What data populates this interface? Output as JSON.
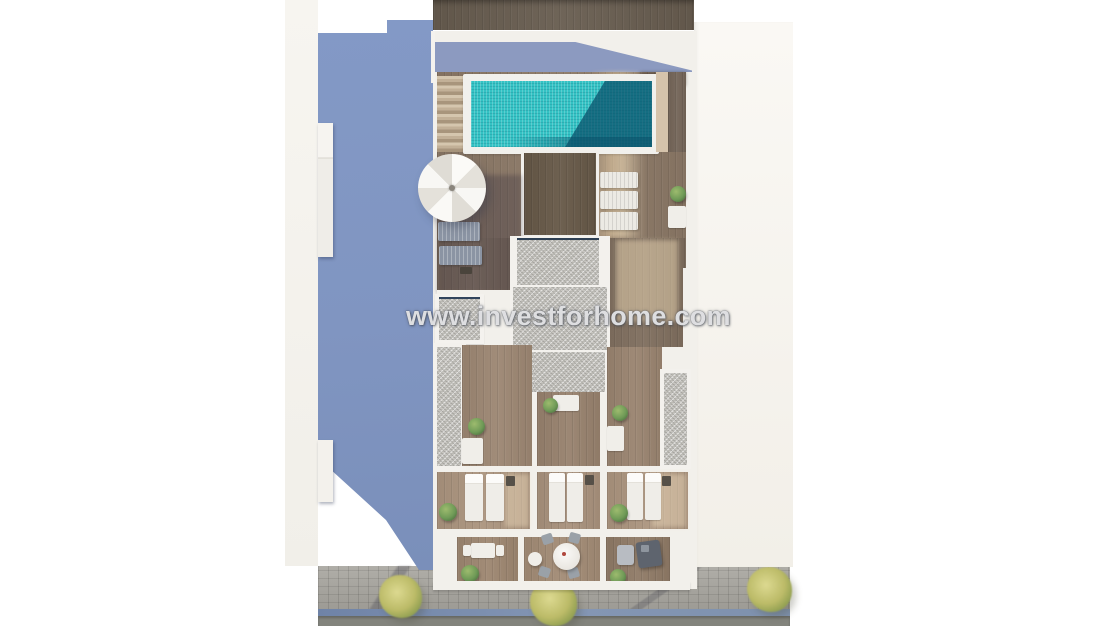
{
  "watermark": {
    "text": "www.investforhome.com"
  },
  "scene": {
    "title": "Aerial 3D architectural render of a townhouse floor plan",
    "elements": [
      "neighbor-building-shadow-wall",
      "roof-wood-band",
      "swimming-pool",
      "pool-stairs",
      "parasol",
      "sun-loungers",
      "roof-terrace-deck",
      "stair-bulkhead",
      "gravel-roof-sections",
      "room-with-table-left",
      "room-with-table-middle",
      "room-with-table-right",
      "bedroom-left",
      "bedroom-middle",
      "bedroom-right",
      "double-beds",
      "nightstands",
      "indoor-plants",
      "terrace-bistro-table",
      "terrace-round-dining-table",
      "terrace-sofa-set",
      "street-sidewalk",
      "street-trees",
      "kerb",
      "road"
    ]
  },
  "palette": {
    "canvas": "#ffffff",
    "warm_white_wall": "#f2f0eb",
    "neighbor_wall_blue": "#8298c4",
    "roof_shadow_blue": "#8c9ac0",
    "dark_roof_wood": "#675c4f",
    "deck_wood": "#8b7866",
    "room_wood": "#9c8672",
    "pool_water": "#33c2c4",
    "pool_shadow": "#0b5a73",
    "gravel": "#c8c6c1",
    "sidewalk": "#a6a49f",
    "kerb_blue": "#7e91ad",
    "road": "#83847d",
    "tree_green": "#bcbb68",
    "plant_green": "#6f9a57"
  }
}
